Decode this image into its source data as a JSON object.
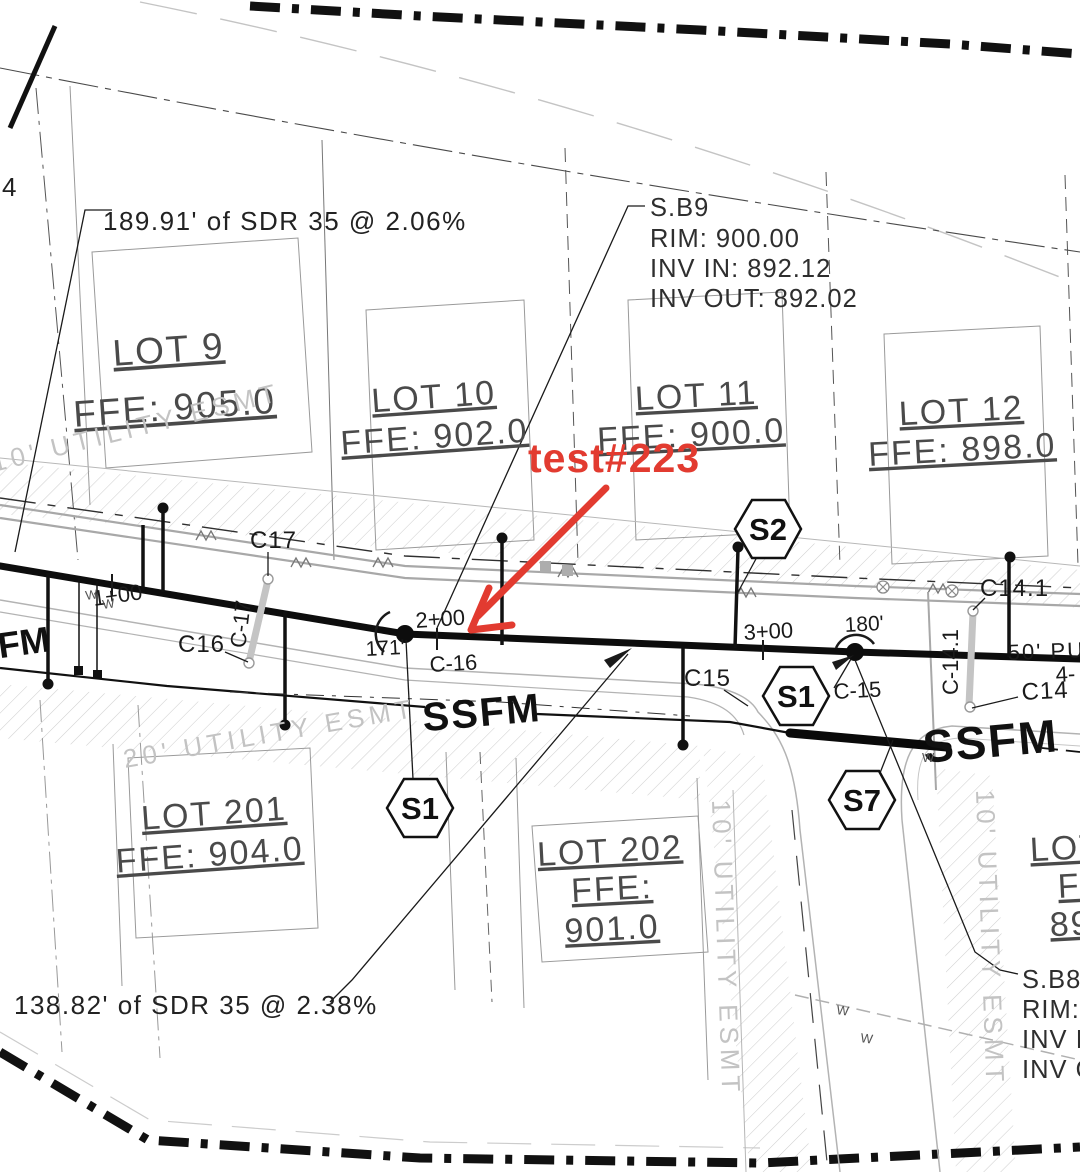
{
  "corner_number": "4",
  "red_note": "test#223",
  "notes": {
    "top": "189.91' of SDR 35 @ 2.06%",
    "bottom": "138.82' of SDR 35 @ 2.38%"
  },
  "structures": {
    "sb9": {
      "name": "S.B9",
      "rim": "RIM: 900.00",
      "inv_in": "INV IN: 892.12",
      "inv_out": "INV OUT: 892.02"
    },
    "sb8": {
      "name": "S.B8",
      "rim": "RIM: 8",
      "inv_in": "INV I",
      "inv_out": "INV O"
    }
  },
  "lots": [
    {
      "name": "LOT 9",
      "ffe": "FFE: 905.0"
    },
    {
      "name": "LOT 10",
      "ffe": "FFE: 902.0"
    },
    {
      "name": "LOT 11",
      "ffe": "FFE: 900.0"
    },
    {
      "name": "LOT 12",
      "ffe": "FFE: 898.0"
    },
    {
      "name": "LOT 201",
      "ffe": "FFE: 904.0"
    },
    {
      "name": "LOT 202",
      "ffe": "FFE:",
      "ffe2": "901.0"
    },
    {
      "name": "LOT",
      "ffe": "FF",
      "ffe2": "89"
    }
  ],
  "easements": {
    "top_left": "10' UTILITY ESMT",
    "mid_left": "20' UTILITY ESMT",
    "vert_1": "10' UTILITY ESMT",
    "vert_2": "10' UTILITY ESMT"
  },
  "callouts": {
    "c17": "C17",
    "c16": "C16",
    "c_16": "C-16",
    "c15": "C15",
    "c_15": "C-15",
    "c14_1": "C14.1",
    "c_14_1": "C-14.1",
    "c14": "C14",
    "c_17": "C-17"
  },
  "hexes": {
    "s2": "S2",
    "s1a": "S1",
    "s1b": "S1",
    "s7": "S7"
  },
  "stations": {
    "s1": "1+00",
    "s2": "2+00",
    "s3": "3+00",
    "s4": "4-"
  },
  "dims": {
    "d1": "171'",
    "d2": "180'"
  },
  "pipes": {
    "fm": "FM",
    "ssfm_mid": "SSFM",
    "ssfm_right": "SSFM"
  },
  "row_label": "50' PUB",
  "w_mark": "W"
}
